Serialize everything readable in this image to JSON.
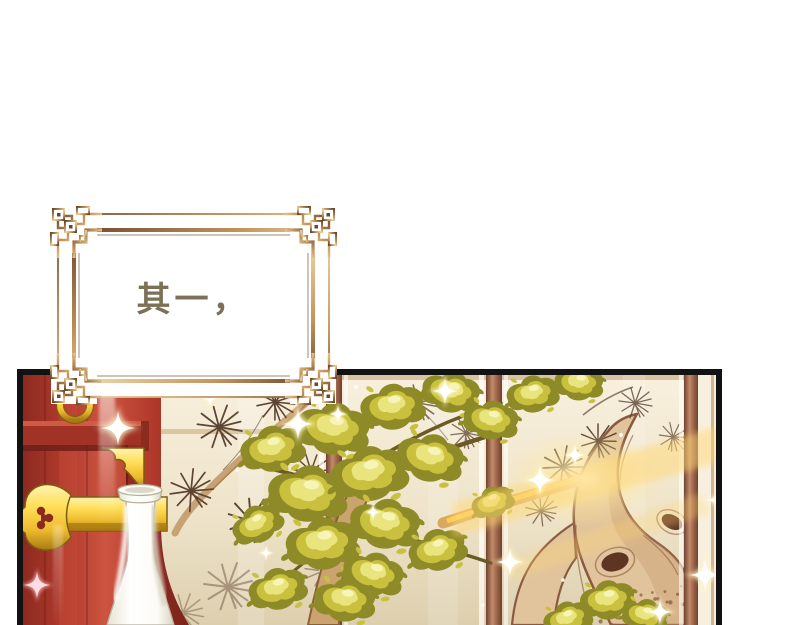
{
  "caption": {
    "text": "其一，"
  },
  "colors": {
    "page-bg": "#ffffff",
    "caption-color": "#7c7157",
    "panel-border": "#121212",
    "frame-gold-light": "#ecd2a0",
    "frame-gold-mid": "#c2945c",
    "frame-gold-dark": "#6a482a",
    "frame-inner-bg": "#ffffff",
    "door-red": "#b23a2c",
    "door-red-dark": "#8c2a20",
    "door-red-deep": "#6e1f17",
    "door-red-light": "#cc5440",
    "gold-bright": "#ffdd55",
    "gold-mid": "#ecb92e",
    "gold-dark": "#a87a10",
    "gold-outline": "#7d5c12",
    "vase-white": "#fcfbf6",
    "vase-shadow": "#d9d4c2",
    "vase-outline": "#b5ae9a",
    "screen-cream": "#efe4ca",
    "screen-cream-light": "#f8f0de",
    "screen-shade": "#ddcfae",
    "wood-brown": "#9a6248",
    "wood-brown-dark": "#6f4130",
    "wood-brown-light": "#c28b69",
    "ink-sepia": "#5d4433",
    "branch-tan": "#c7a275",
    "trunk-fill": "#e2c49c",
    "trunk-outline": "#8a5a40",
    "trunk-knot": "#5e3423",
    "leaf-dark": "#8f8a28",
    "leaf-mid": "#c9c13d",
    "leaf-light": "#e9e47e",
    "leaf-pale": "#f7f4bb",
    "flare-gold": "#ffd875",
    "sparkle-white": "#ffffff"
  }
}
